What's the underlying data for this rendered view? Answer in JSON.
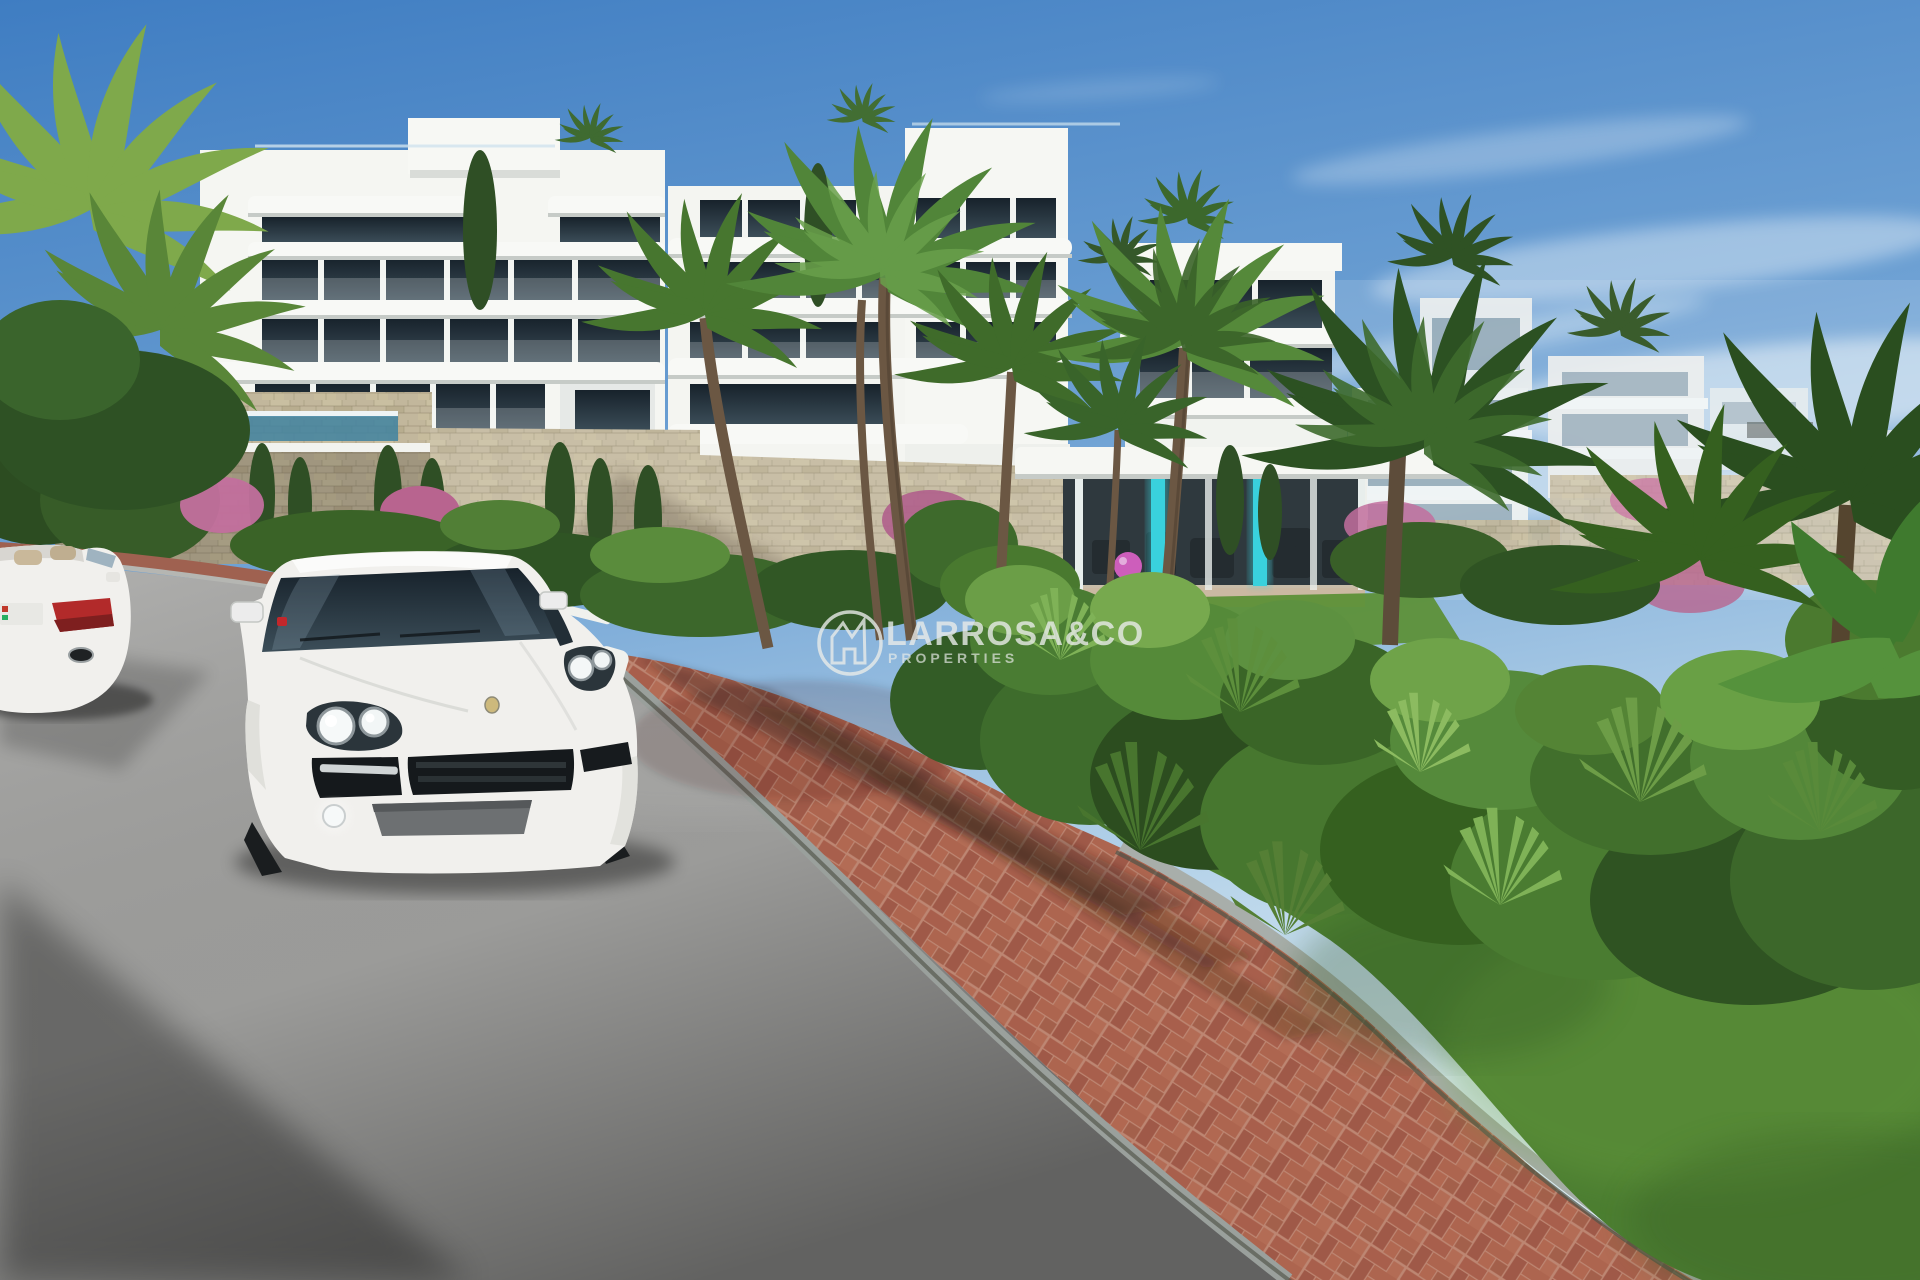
{
  "watermark": {
    "brand": "LARROSA&CO",
    "tagline": "PROPERTIES",
    "icon": "house-crown",
    "color": "#e9ece9"
  },
  "scene": {
    "type": "architectural-render",
    "subject": "Modern white terraced apartment complex with palm gardens, stacked-stone walls, glass-fronted gym, red brick footpath, asphalt road, white SUV and white convertible",
    "colors": {
      "sky_top": "#3f7dc2",
      "sky_horizon": "#ddecf6",
      "cloud": "#f4f9fc",
      "building_white": "#f5f6f2",
      "building_shadow": "#d7dbd8",
      "window_dark": "#2d3e49",
      "window_reflection": "#9fc0d3",
      "stone_wall": "#c2b79c",
      "road": "#a3a3a1",
      "road_shadow": "#5f5f5d",
      "curb": "#9ba19d",
      "brick": "#ab634f",
      "brick_mortar": "#bd8672",
      "lawn": "#4c7e31",
      "foliage_dark": "#2c4c21",
      "foliage_mid": "#4c7c33",
      "foliage_bright": "#74a94c",
      "palm_trunk": "#6b5743",
      "flower_pink": "#c26f9d",
      "pool_glass": "#3f82a0",
      "gym_interior": "#20262b",
      "gym_led": "#2bd0dc",
      "exercise_ball": "#d050b6",
      "car_white": "#f1f0ed",
      "taillight_red": "#b22a2a",
      "signal_red": "#c3272b"
    }
  }
}
